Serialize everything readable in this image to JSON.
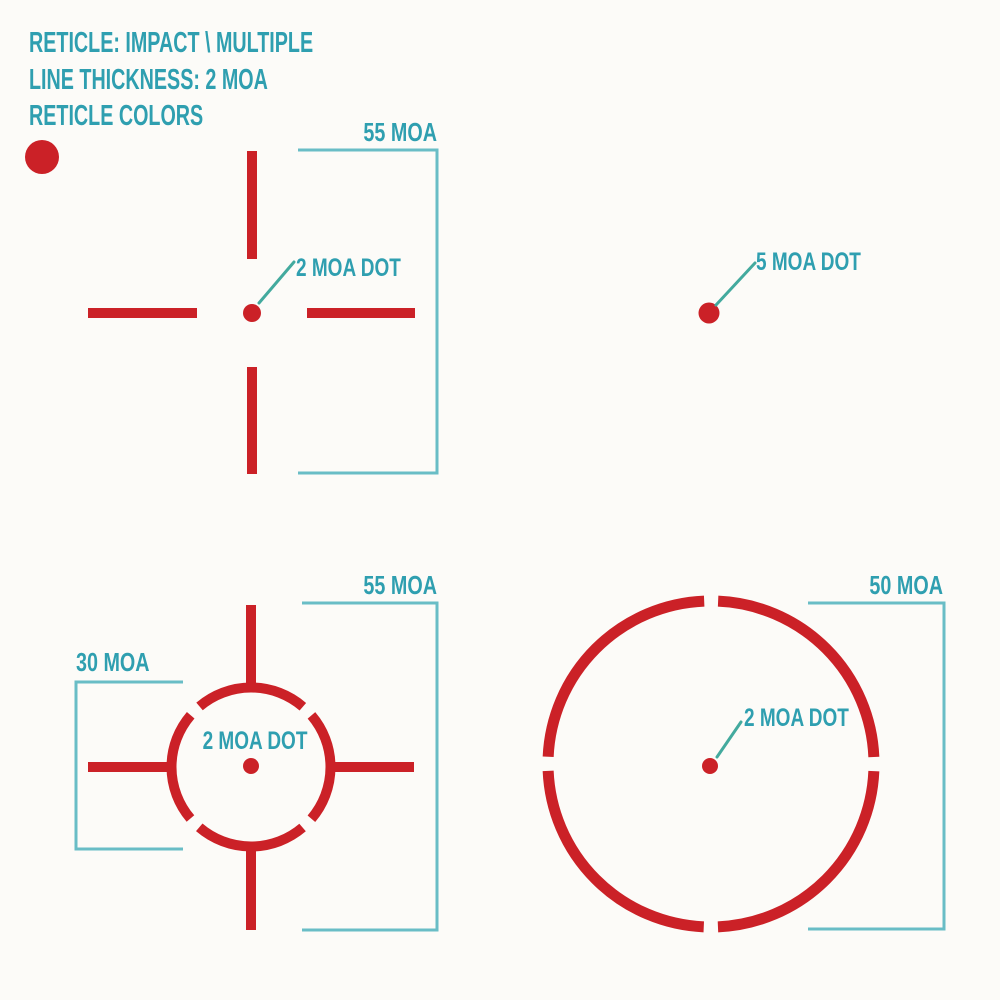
{
  "title": {
    "line1": "RETICLE: IMPACT \\ MULTIPLE",
    "line2": "LINE THICKNESS: 2 MOA",
    "line3": "RETICLE COLORS"
  },
  "colors": {
    "reticle_red": "#cb2127",
    "label_teal": "#2f9fb0",
    "bracket_teal": "#69bdc6",
    "leader_teal": "#43aa9e",
    "background": "#fcfbf8"
  },
  "swatch": {
    "name": "red"
  },
  "reticles": {
    "crosshair_dot": {
      "dot_label": "2 MOA DOT",
      "height_dim": "55 MOA"
    },
    "single_dot": {
      "dot_label": "5 MOA DOT"
    },
    "circle_dot_crosshair": {
      "dot_label": "2 MOA DOT",
      "circle_dim": "30 MOA",
      "height_dim": "55 MOA"
    },
    "segmented_circle_dot": {
      "dot_label": "2 MOA DOT",
      "diameter_dim": "50 MOA"
    }
  }
}
